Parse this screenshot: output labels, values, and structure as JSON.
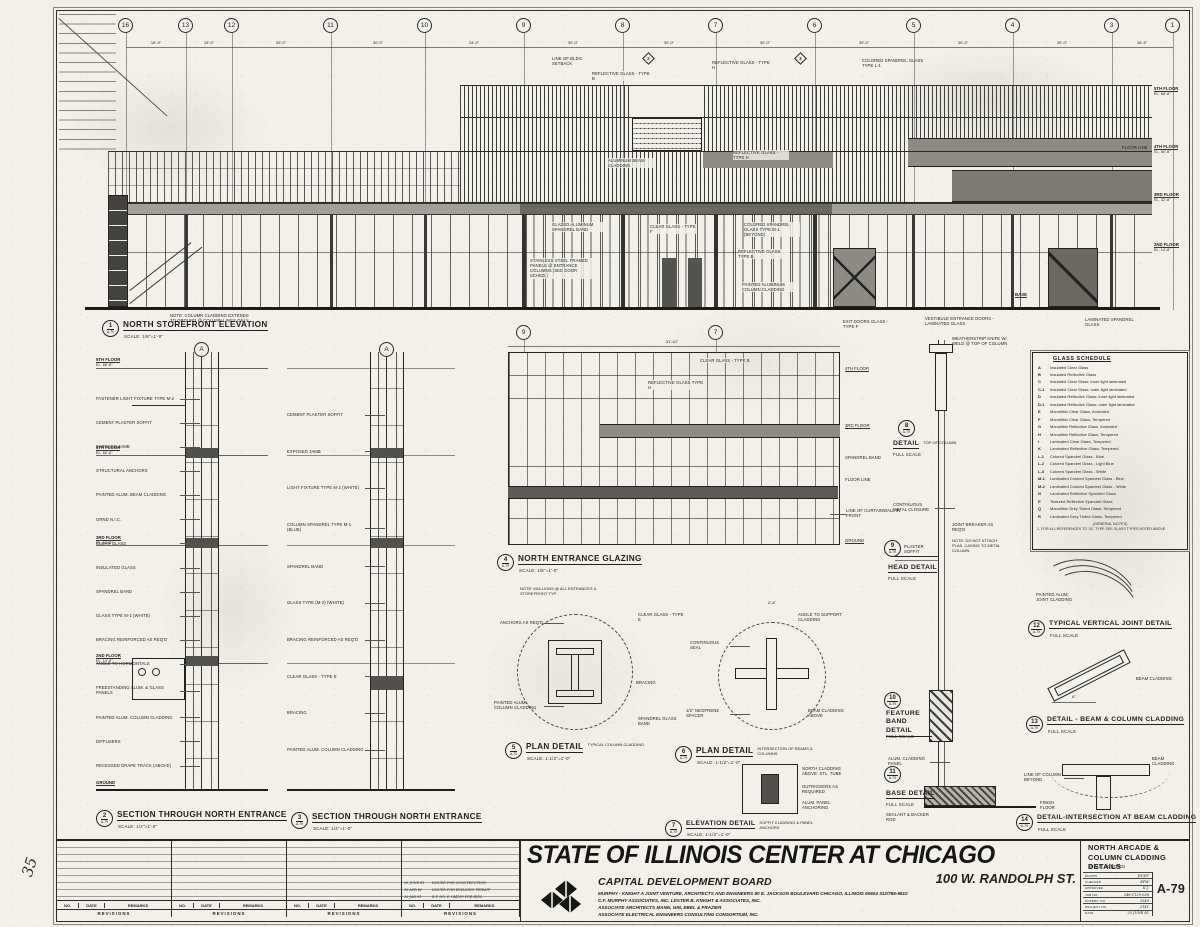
{
  "sheet": {
    "detail_ref": "A-79",
    "margin_note": "35"
  },
  "grid": {
    "bubbles": [
      "16",
      "13",
      "12",
      "11",
      "10",
      "9",
      "8",
      "7",
      "6",
      "5",
      "4",
      "3",
      "1"
    ],
    "dims": [
      "18'-9\"",
      "15'-0\"",
      "30'-0\"",
      "30'-0\"",
      "24'-0\"",
      "30'-0\"",
      "30'-0\"",
      "30'-0\"",
      "30'-0\"",
      "30'-0\"",
      "30'-0\"",
      "18'-9\""
    ],
    "section_bubbles": [
      "9",
      "7"
    ],
    "section_letters": [
      "A",
      "A"
    ],
    "cut_markers": [
      "2",
      "3"
    ]
  },
  "floors": [
    {
      "label": "5TH FLOOR",
      "el": "EL. 68'-8\""
    },
    {
      "label": "4TH FLOOR",
      "el": "EL. 50'-8\""
    },
    {
      "label": "3RD FLOOR",
      "el": "EL. 32'-8\""
    },
    {
      "label": "2ND FLOOR",
      "el": "EL. 14'-8\""
    }
  ],
  "base_label": "BASE",
  "ground_label": "GROUND",
  "floor_line_label": "FLOOR LINE",
  "drawings": [
    {
      "num": "1",
      "title": "NORTH STOREFRONT ELEVATION",
      "scale": "SCALE: 1/8\"=1'-0\""
    },
    {
      "num": "2",
      "title": "SECTION THROUGH NORTH ENTRANCE",
      "scale": "SCALE: 1/4\"=1'-0\""
    },
    {
      "num": "3",
      "title": "SECTION THROUGH NORTH ENTRANCE",
      "scale": "SCALE: 1/4\"=1'-0\""
    },
    {
      "num": "4",
      "title": "NORTH ENTRANCE GLAZING",
      "scale": "SCALE: 1/8\"=1'-0\""
    },
    {
      "num": "5",
      "title": "PLAN DETAIL",
      "subtitle": "TYPICAL COLUMN CLADDING",
      "scale": "SCALE: 1-1/2\"=1'-0\""
    },
    {
      "num": "6",
      "title": "PLAN DETAIL",
      "subtitle": "INTERSECTION OF BEAMS & COLUMNS",
      "scale": "SCALE: 1-1/2\"=1'-0\""
    },
    {
      "num": "7",
      "title": "ELEVATION DETAIL",
      "subtitle": "SOFFIT CLADDING & PANEL ANCHORS",
      "scale": "SCALE: 1-1/2\"=1'-0\""
    },
    {
      "num": "8",
      "title": "DETAIL",
      "subtitle": "TOP OF COLUMN",
      "scale": "FULL SCALE"
    },
    {
      "num": "9",
      "title": "HEAD DETAIL",
      "scale": "FULL SCALE"
    },
    {
      "num": "10",
      "title": "FEATURE BAND DETAIL",
      "scale": "FULL SCALE"
    },
    {
      "num": "11",
      "title": "BASE DETAIL",
      "scale": "FULL SCALE"
    },
    {
      "num": "12",
      "title": "TYPICAL VERTICAL JOINT DETAIL",
      "scale": "FULL SCALE"
    },
    {
      "num": "13",
      "title": "DETAIL - BEAM & COLUMN CLADDING",
      "scale": "FULL SCALE"
    },
    {
      "num": "14",
      "title": "DETAIL-INTERSECTION AT BEAM CLADDING",
      "scale": "FULL SCALE"
    }
  ],
  "elevation": {
    "callouts": [
      "LINE OF BLDG. SETBACK",
      "REFLECTIVE GLASS - TYPE H",
      "REFLECTIVE GLASS - TYPE B",
      "COLORED SPANDREL GLASS TYPE L-1",
      "ALUMINUM BEAM CLADDING",
      "REFLECTIVE GLASS - TYPE H",
      "CLEAR GLASS - TYPE F",
      "COLORED SPANDREL GLASS TYPE M-1 (BEYOND)",
      "GLAZED ALUMINUM SPANDREL BAND",
      "REFLECTIVE GLASS TYPE B",
      "STAINLESS STEEL FRAMED PANELS @ ENTRANCE COLUMNS (SEE DOOR SCHED.)",
      "PAINTED ALUMINUM COLUMN CLADDING",
      "EXIT DOORS GLASS - TYPE F",
      "VESTIBULE ENTRANCE DOORS - LAMINATED GLASS",
      "NOTE: COLUMN CLADDING EXTENDS TO GROUND @ COLUMN LINES ONLY",
      "LAMINATED SPANDREL GLASS"
    ]
  },
  "section2": {
    "callouts": [
      "FASTENER LIGHT FIXTURE TYPE M-2",
      "CEMENT PLASTER SOFFIT",
      "EXPOSED JAMB",
      "STRUCTURAL ANCHORS",
      "PAINTED ALUM. BEAM CLADDING",
      "GRND N.I.C.",
      "CLEAR GLASS",
      "INSULATED GLASS",
      "SPANDREL BAND",
      "GLASS TYPE M-2 (WHITE)",
      "BRACING REINFORCED AS REQ'D",
      "ANGLE TO HORIZONTALS",
      "FREESTANDING ALUM. & GLASS PANELS",
      "PAINTED ALUM. COLUMN CLADDING",
      "DIFFUSERS",
      "RECESSED DRAPE TRACK (ABOVE)"
    ]
  },
  "section3": {
    "callouts": [
      "CEMENT PLASTER SOFFIT",
      "EXPOSED JAMB",
      "LIGHT FIXTURE TYPE M-2 (WHITE)",
      "COLUMN SPANDREL TYPE M-1 (BLUE)",
      "SPANDREL BAND",
      "GLASS TYPE (M-2) (WHITE)",
      "BRACING REINFORCED AS REQ'D",
      "CLEAR GLASS - TYPE E",
      "BRACING",
      "PAINTED ALUM. COLUMN CLADDING"
    ]
  },
  "glazing4": {
    "top_dim": "31'-10\"",
    "labels_right": [
      "4TH FLOOR",
      "3RD FLOOR",
      "SPANDREL BAND",
      "FLOOR LINE",
      "GROUND"
    ],
    "callouts": [
      "CLEAR GLASS - TYPE B",
      "REFLECTIVE GLASS TYPE H",
      "LINE OF CURTAINWALL IN FRONT"
    ],
    "note": "NOTE: MULLIONS @ ALL ENTRANCES & STOREFRONT TYP."
  },
  "detail5": {
    "callouts": [
      "ANCHORS AS REQ'D",
      "PAINTED ALUM. COLUMN CLADDING",
      "CLEAR GLASS - TYPE E",
      "SPANDREL GLASS BAND",
      "BRACING"
    ]
  },
  "detail6": {
    "callouts": [
      "ANGLE TO SUPPORT CLADDING",
      "CONTINUOUS SEAL",
      "1/2\" NEOPRENE SPACER",
      "BEAM CLADDING ABOVE"
    ],
    "dim": "2'-4\""
  },
  "detail7": {
    "callouts": [
      "NORTH CLADDING ABOVE: STL. TUBE",
      "OUTRIGGERS AS REQUIRED",
      "ALUM. PANEL ANCHORING"
    ]
  },
  "detail8": {
    "callout": "WEATHERSTRIP KNIFE W/ WELD @ TOP OF COLUMN"
  },
  "detail9": {
    "callout": "PLASTER SOFFIT",
    "note": "NOTE: DO NOT ATTACH PLAS. CASING TO METAL COLUMN"
  },
  "strip": {
    "mid1": "CONTINUOUS METAL CLOSURE",
    "mid2": "JOINT BREAKER AS REQ'D"
  },
  "detail10": {
    "callout": "ALUM. CLADDING PANEL"
  },
  "detail11": {
    "callout": "SEALANT & BACKER ROD",
    "floor": "FINISH FLOOR"
  },
  "detail12": {
    "callout": "PAINTED ALUM. JOINT CLADDING"
  },
  "detail13": {
    "callout": "BEAM CLADDING",
    "dim": "6\""
  },
  "detail14": {
    "callouts": [
      "LINE OF COLUMN BEYOND",
      "BEAM CLADDING"
    ]
  },
  "glass_schedule": {
    "title": "GLASS SCHEDULE",
    "rows": [
      {
        "key": "A",
        "desc": "Insulated Clear Glass"
      },
      {
        "key": "B",
        "desc": "Insulated Reflective Glass"
      },
      {
        "key": "C",
        "desc": "Insulated Clear Glass; inner light laminated"
      },
      {
        "key": "C-1",
        "desc": "Insulated Clear Glass; outer light laminated"
      },
      {
        "key": "D",
        "desc": "Insulated Reflective Glass; inner light laminated"
      },
      {
        "key": "D-1",
        "desc": "Insulated Reflective Glass; outer light laminated"
      },
      {
        "key": "E",
        "desc": "Monolithic Clear Glass, Annealed"
      },
      {
        "key": "F",
        "desc": "Monolithic Clear Glass, Tempered"
      },
      {
        "key": "G",
        "desc": "Monolithic Reflective Glass, Annealed"
      },
      {
        "key": "H",
        "desc": "Monolithic Reflective Glass, Tempered"
      },
      {
        "key": "I",
        "desc": "Laminated Clear Glass, Tempered"
      },
      {
        "key": "K",
        "desc": "Laminated Reflective Glass, Tempered"
      },
      {
        "key": "L-1",
        "desc": "Colored Spandrel Glass - Blue"
      },
      {
        "key": "L-2",
        "desc": "Colored Spandrel Glass - Light Blue"
      },
      {
        "key": "L-3",
        "desc": "Colored Spandrel Glass - White"
      },
      {
        "key": "M-1",
        "desc": "Laminated Colored Spandrel Glass - Blue"
      },
      {
        "key": "M-2",
        "desc": "Laminated Colored Spandrel Glass - White"
      },
      {
        "key": "N",
        "desc": "Laminated Reflective Spandrel Glass"
      },
      {
        "key": "P",
        "desc": "Textured Reflective Spandrel Glass"
      },
      {
        "key": "Q",
        "desc": "Monolithic Grey Tinted Glass, Tempered"
      },
      {
        "key": "R",
        "desc": "Laminated Grey Tinted Glass, Tempered"
      }
    ],
    "notes_title": "(GENERAL NOTES)",
    "note1": "1. FOR ALL REFERENCES TO 'GL' TYPE SEE GLASS TYPES NOTED ABOVE."
  },
  "titleblock": {
    "project": "STATE OF ILLINOIS CENTER AT CHICAGO",
    "board": "CAPITAL DEVELOPMENT BOARD",
    "address": "100 W. RANDOLPH ST.",
    "credit1": "MURPHY - KNIGHT   A JOINT VENTURE, ARCHITECTS AND ENGINEERS   80 E. JACKSON BOULEVARD   CHICAGO, ILLINOIS 60604   312/786-9610",
    "credit2": "C.F. MURPHY ASSOCIATES, INC.    LESTER B. KNIGHT & ASSOCIATES, INC.",
    "credit3": "ASSOCIATE ARCHITECTS    MANN, GIN, EBEL & FRAZIER",
    "credit4": "ASSOCIATE ELECTRICAL ENGINEERS    CONSULTING CONSORTIUM, INC.",
    "sheet_title1": "NORTH ARCADE &",
    "sheet_title2": "COLUMN CLADDING DETAILS",
    "scale_note": "SCALE: AS NOTED",
    "sheet_number": "A-79",
    "fields": [
      {
        "label": "DRAWN",
        "value": "JW/RT"
      },
      {
        "label": "CHECKED",
        "value": "EPW"
      },
      {
        "label": "APPROVED",
        "value": "K.J."
      },
      {
        "label": "JOB NO.",
        "value": "248-1129-038"
      },
      {
        "label": "SUPERV. NO.",
        "value": "2549"
      },
      {
        "label": "PROJECT NO.",
        "value": "2141"
      },
      {
        "label": "DATE",
        "value": "25 JUNE 81"
      }
    ]
  },
  "revisions": {
    "headers": {
      "no": "NO.",
      "date": "DATE",
      "remarks": "REMARKS"
    },
    "label": "REVISIONS",
    "entries": [
      {
        "date": "25 JUNE 81",
        "remarks": "ISSUED FOR CONSTRUCTION"
      },
      {
        "date": "16 APR 81",
        "remarks": "ISSUED FOR BUILDING PERMIT"
      },
      {
        "date": "30 JAN 81",
        "remarks": "B.P. NO. E-144150 FOR BIDS"
      }
    ]
  }
}
